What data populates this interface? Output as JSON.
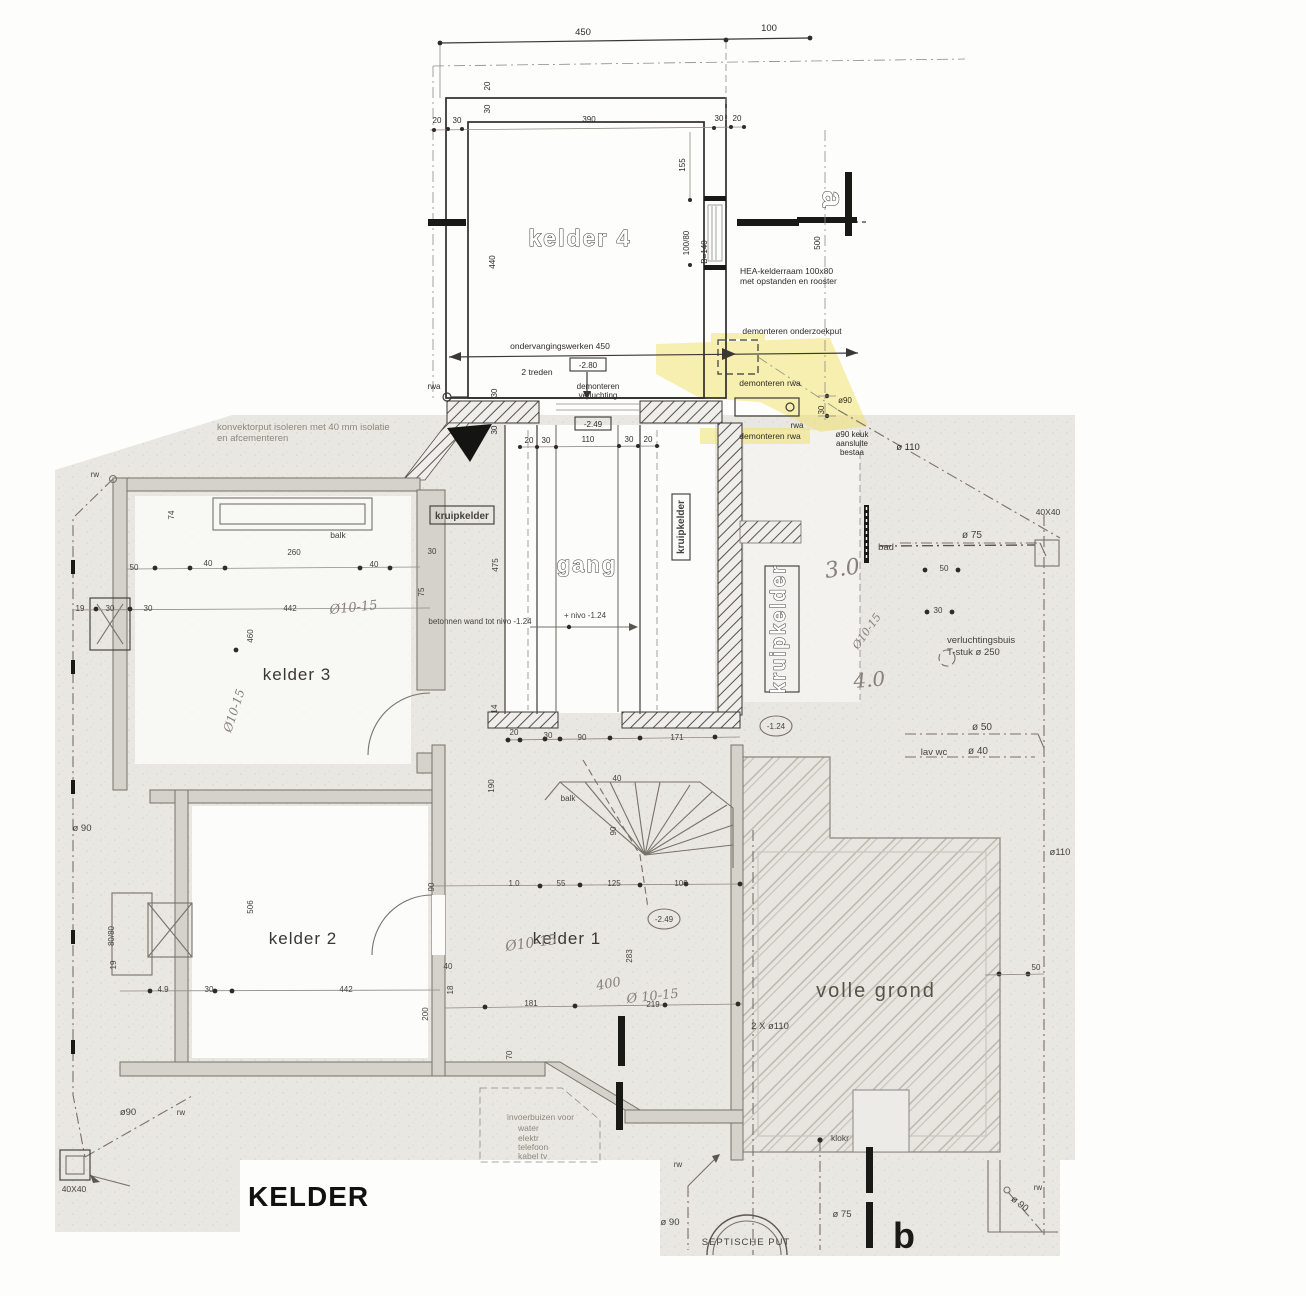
{
  "title": "KELDER",
  "rooms": {
    "kelder4": "kelder 4",
    "kelder3": "kelder 3",
    "kelder2": "kelder 2",
    "kelder1": "kelder 1",
    "gang": "gang",
    "volle_grond": "volle grond",
    "kruipkelder": "kruipkelder",
    "septische_put": "SEPTISCHE PUT"
  },
  "sections": {
    "a": "a",
    "b": "b"
  },
  "levels": {
    "m280": "-2.80",
    "m249": "-2.49",
    "m124": "-1.24",
    "nivo": "+ nivo -1.24"
  },
  "annotations": {
    "hea_line1": "HEA-kelderraam 100x80",
    "hea_line2": "met opstanden en rooster",
    "demonteren_onderzoekput": "demonteren onderzoekput",
    "ondervangingswerken": "ondervangingswerken 450",
    "treden": "2 treden",
    "demonteren": "demonteren",
    "verluchting": "verluchting",
    "demonteren_rwa": "demonteren rwa",
    "keuk_line1": "ø90 keuk",
    "keuk_line2": "aansluite",
    "keuk_line3": "bestaa",
    "konvektor_line1": "konvektorput isoleren met 40 mm isolatie",
    "konvektor_line2": "en afcementeren",
    "betonnen_wand": "betonnen wand tot nivo -1.24",
    "verluchtingsbuis": "verluchtingsbuis",
    "t_stuk": "T-stuk  ø 250",
    "invoer_line1": "invoerbuizen voor",
    "invoer_water": "water",
    "invoer_elektr": "elektr",
    "invoer_telefoon": "telefoon",
    "invoer_kabel": "kabel tv",
    "balk": "balk",
    "bad": "bad",
    "lav_wc": "lav wc",
    "klokr": "klokr",
    "rwa": "rwa",
    "rw": "rw"
  },
  "pipes": {
    "dia110": "ø 110",
    "dia110s": "ø110",
    "dia90": "ø 90",
    "dia90s": "ø90",
    "dia75": "ø 75",
    "dia50": "ø 50",
    "dia40": "ø 40",
    "two_x_dia110": "2 X ø110",
    "size_4040": "40X40"
  },
  "dims": {
    "d450": "450",
    "d100": "100",
    "d20": "20",
    "d30": "30",
    "d390": "390",
    "d155": "155",
    "d100_80": "100/80",
    "dB140": "B=140",
    "d440": "440",
    "d500": "500",
    "d110": "110",
    "d475": "475",
    "d14": "14",
    "d50": "50",
    "d40": "40",
    "d74": "74",
    "d260": "260",
    "d442": "442",
    "d460": "460",
    "d19": "19",
    "d75": "75",
    "d506": "506",
    "d80_80": "80/80",
    "d4_9": "4.9",
    "d90": "90",
    "d18": "18",
    "d200": "200",
    "d70": "70",
    "d190": "190",
    "d1_0": "1.0",
    "d55": "55",
    "d125": "125",
    "d283": "283",
    "d181": "181",
    "d219": "219",
    "d171": "171"
  },
  "handwritten": {
    "h3_0": "3.0",
    "h4_0": "4.0",
    "h400": "400",
    "h1015": "Ø10-15",
    "h1015b": "Ø 10-15"
  },
  "colors": {
    "paper": "#fdfdfb",
    "scan_gray": "#e9e7e2",
    "ink": "#3a3834",
    "highlight_yellow": "#f2e265",
    "ground_hatch": "#b6b2a9"
  }
}
